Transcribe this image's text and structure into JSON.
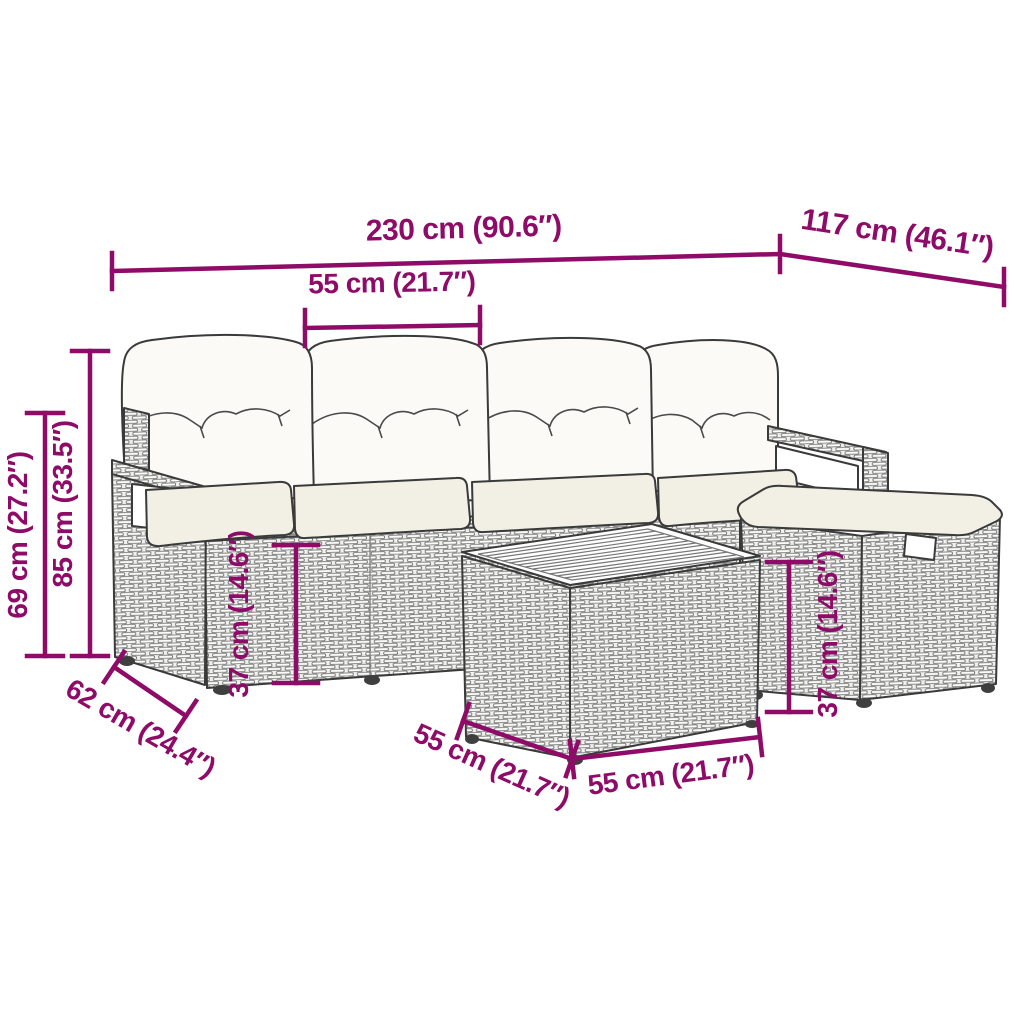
{
  "colors": {
    "accent": "#8e0b68",
    "outline": "#3a3a3a",
    "background": "#ffffff",
    "back_cushion": "#fbfaf6",
    "seat_cushion": "#f2efe5"
  },
  "dims": {
    "total_width": "230 cm (90.6″)",
    "total_depth": "117 cm (46.1″)",
    "seat_width": "55 cm (21.7″)",
    "armrest_height": "69 cm (27.2″)",
    "total_height": "85 cm (33.5″)",
    "seat_height": "37 cm (14.6″)",
    "side_depth": "62 cm (24.4″)",
    "table_length": "55 cm (21.7″)",
    "table_width": "55 cm (21.7″)",
    "stool_height": "37 cm (14.6″)"
  }
}
